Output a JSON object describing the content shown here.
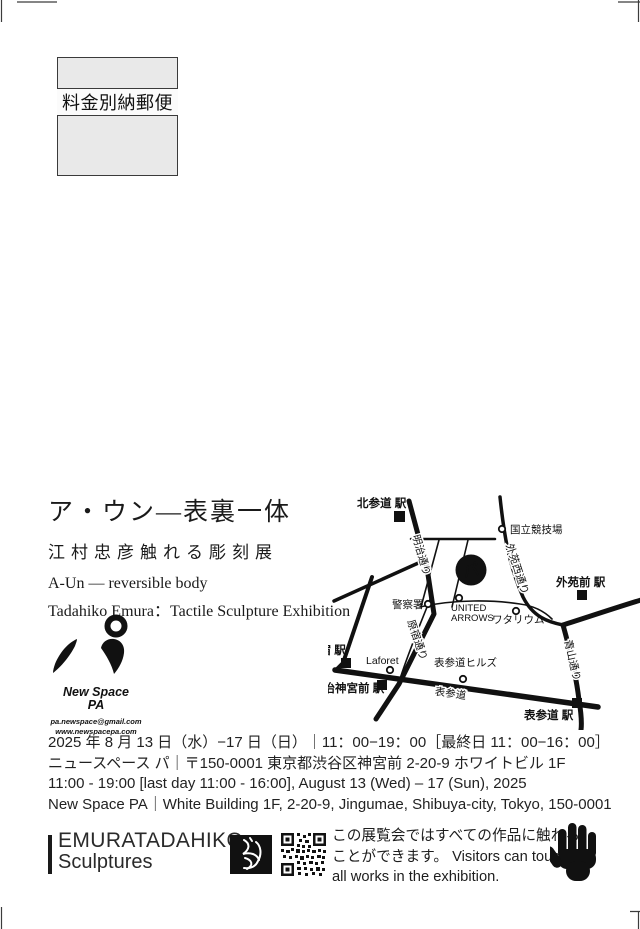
{
  "postage_mark": {
    "label": "料金別納郵便"
  },
  "title_block": {
    "title_jp": "ア・ウン—表裏一体",
    "subtitle_jp": "江村忠彦触れる彫刻展",
    "title_en": "A-Un — reversible body",
    "subtitle_en": "Tadahiko Emura：Tactile Sculpture Exhibition"
  },
  "logo": {
    "glyph": "パ",
    "name_line1": "New Space",
    "name_line2": "PA",
    "email": "pa.newspace@gmail.com",
    "website": "www.newspacepa.com"
  },
  "map": {
    "venue_glyph": "パ",
    "stations": [
      {
        "id": "kitasando",
        "label": "北参道 駅"
      },
      {
        "id": "gaienmae",
        "label": "外苑前 駅"
      },
      {
        "id": "harajuku",
        "label": "原宿 駅"
      },
      {
        "id": "meijijingumae",
        "label": "明治神宮前 駅"
      },
      {
        "id": "omotesando",
        "label": "表参道 駅"
      }
    ],
    "pois": [
      {
        "id": "national-stadium",
        "label": "国立競技場"
      },
      {
        "id": "police-station",
        "label": "警察署"
      },
      {
        "id": "united-arrows-1",
        "label": "UNITED"
      },
      {
        "id": "united-arrows-2",
        "label": "ARROWS"
      },
      {
        "id": "watarium",
        "label": "ワタリウム"
      },
      {
        "id": "laforet",
        "label": "Laforet"
      },
      {
        "id": "omotesando-hills",
        "label": "表参道ヒルズ"
      }
    ],
    "roads": [
      {
        "id": "meiji-dori",
        "label": "明治通り"
      },
      {
        "id": "harajuku-dori",
        "label": "原宿通り"
      },
      {
        "id": "gaien-nishi-dori",
        "label": "外苑西通り"
      },
      {
        "id": "aoyama-dori",
        "label": "青山通り"
      },
      {
        "id": "omotesando-ave",
        "label": "表参道"
      }
    ]
  },
  "info_block": {
    "line1_jp": "2025 年 8 月 13 日（水）−17 日（日）｜11：00−19：00［最終日 11：00−16：00］",
    "line2_jp": "ニュースペース パ｜〒150-0001 東京都渋谷区神宮前 2-20-9 ホワイトビル 1F",
    "line3_en": "11:00 - 19:00 [last day 11:00 - 16:00], August 13 (Wed) – 17 (Sun), 2025",
    "line4_en": "New Space PA｜White Building 1F, 2-20-9, Jingumae, Shibuya-city, Tokyo, 150-0001"
  },
  "footer": {
    "artist_line1": "EMURATADAHIKO",
    "artist_line2": "Sculptures",
    "notice_line1": "この展覧会ではすべての作品に触れる",
    "notice_line2": "ことができます。 Visitors can touch",
    "notice_line3": "all works in the exhibition."
  },
  "colors": {
    "ink": "#111111",
    "stamp_fill": "#e9e9e9"
  }
}
